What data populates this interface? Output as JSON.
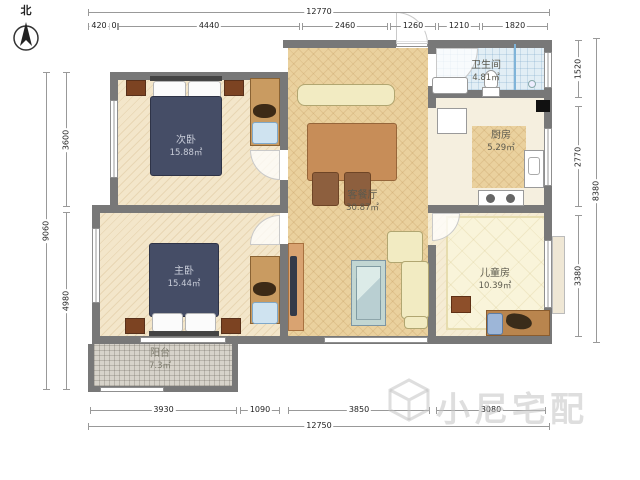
{
  "north": {
    "label": "北"
  },
  "watermark": {
    "text": "小尼宅配"
  },
  "rooms": {
    "living": {
      "name": "客餐厅",
      "area": "30.87㎡"
    },
    "bed2": {
      "name": "次卧",
      "area": "15.88㎡"
    },
    "bed1": {
      "name": "主卧",
      "area": "15.44㎡"
    },
    "bath": {
      "name": "卫生间",
      "area": "4.81㎡"
    },
    "kitchen": {
      "name": "厨房",
      "area": "5.29㎡"
    },
    "kids": {
      "name": "儿童房",
      "area": "10.39㎡"
    },
    "balcony": {
      "name": "阳台",
      "area": "7.3㎡"
    }
  },
  "dims": {
    "top_total": "12770",
    "top_segs": [
      "420",
      "0",
      "4440",
      "2460",
      "1260",
      "1210",
      "1820"
    ],
    "bottom_total": "12750",
    "bottom_segs": [
      "3930",
      "1090",
      "3850",
      "3080"
    ],
    "left_total": "9060",
    "left_segs": [
      "3600",
      "4980"
    ],
    "right_total": "8380",
    "right_segs": [
      "1520",
      "2770",
      "3380"
    ]
  }
}
